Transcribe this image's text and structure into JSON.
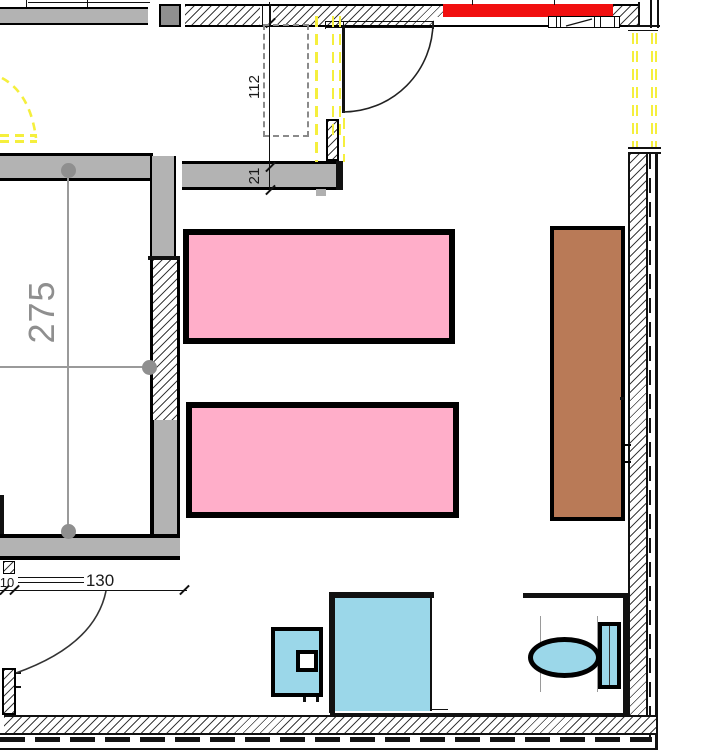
{
  "plan": {
    "title": "apartment-floor-plan-fragment",
    "dimensions": {
      "left_room_width": "275",
      "top_door_width": "112",
      "wall_thickness": "21",
      "bottom_door_width": "130",
      "bottom_door_offset": "10"
    },
    "colors": {
      "wall": "#b3b3b3",
      "pier": "#8f8f8f",
      "centerline": "#9a9a9a",
      "bed": "#ffaec9",
      "wardrobe": "#b97a57",
      "fixture": "#9bd7e9",
      "highlight": "#f10f0f",
      "window": "#f5ef3d"
    },
    "objects": {
      "beds": 2,
      "wardrobe": 1,
      "toilet": 1,
      "shower": 1,
      "cabinet": 1
    }
  }
}
